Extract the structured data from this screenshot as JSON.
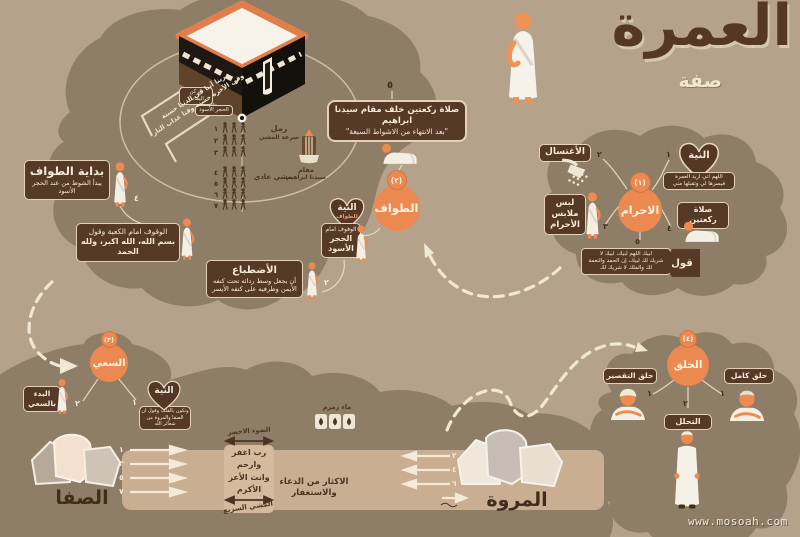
{
  "colors": {
    "background": "#b4a28b",
    "blob": "#8e7d67",
    "badge_brown": "#563a28",
    "accent_orange": "#eb8950",
    "cream": "#f3e9d6",
    "track_band": "#c9ae92",
    "title_brown": "#543823"
  },
  "title": {
    "main": "العمرة",
    "sub": "صفة"
  },
  "watermark": "www.mosoah.com",
  "kaaba": {
    "yemeni_corner": "الركن اليماني",
    "black_stone": "الحجر الأسود",
    "dua_l1": "ربنا آتنا في الدنيا حسنة",
    "dua_l2": "وفي الآخرة حسنة وقنا عذاب النار"
  },
  "ihram": {
    "circle_num": "(١)",
    "circle_label": "الاحرام",
    "niyyah": {
      "num": "١",
      "title": "النية",
      "l1": "اللهم اني اريد العمرة",
      "l2": "فيسرها لي وتقبلها مني"
    },
    "ghusl": {
      "num": "٢",
      "label": "الأغتسال"
    },
    "clothes": {
      "num": "٣",
      "l1": "لبس",
      "l2": "ملابس",
      "l3": "الأحرام"
    },
    "prayer": {
      "num": "٤",
      "label": "صلاة ركعتين"
    },
    "talbiyah": {
      "num": "٥",
      "tag": "قول",
      "l1": "لبيك اللهم لبيك، لبيك لا",
      "l2": "شريك لك لبيك، إن الحمد والنعمة",
      "l3": "لك والملك لا شريك لك"
    }
  },
  "tawaf": {
    "circle_num": "(٢)",
    "circle_label": "الطواف",
    "start": {
      "num": "٤",
      "title": "بداية الطواف",
      "sub": "يبدأ الشوط من عند الحجر الأسود"
    },
    "stand_kaaba": {
      "l1": "الوقوف امام الكعبة وقول",
      "l2": "بسم الله، الله اكبر، ولله الحمد"
    },
    "idtibaa": {
      "num": "٢",
      "title": "الأضطباع",
      "l1": "أن يجعل وسط ردائه تحت كتفه",
      "l2": "الأيمن وطرفيه على كتفه الأيسر"
    },
    "niyyah": {
      "title": "النية",
      "sub": "للطواف"
    },
    "stand_stone": {
      "l1": "الوقوف امام",
      "l2": "الحجر",
      "l3": "الأسود"
    },
    "raml": {
      "nums": [
        "١",
        "٢",
        "٣"
      ],
      "l1": "رمل",
      "l2": "سرعة المشي"
    },
    "walk": {
      "nums": [
        "٤",
        "٥",
        "٦",
        "٧"
      ],
      "label": "مشي عادي"
    },
    "maqam": {
      "l1": "مقام",
      "l2": "سيدنا ابراهيم"
    },
    "prayer": {
      "num": "٥",
      "l1": "صلاة ركعتين خلف مقام سيدنا ابراهيم",
      "l2": "\"بعد الانتهاء من الاشواط السبعة\""
    }
  },
  "sai": {
    "circle_num": "(٣)",
    "circle_label": "السعي",
    "niyyah": {
      "num": "١",
      "title": "النية",
      "l1": "وتكون بالقلب وقول ان",
      "l2": "الصفا والمروة من شعائر الله"
    },
    "start": {
      "num": "٢",
      "l1": "البدء",
      "l2": "بالسعي"
    },
    "safa": "الصفا",
    "marwa": "المروة",
    "to_marwa_nums": [
      "١",
      "٣",
      "٥",
      "٧"
    ],
    "to_safa_nums": [
      "٢",
      "٤",
      "٦"
    ],
    "green_light": "الضوء الاخضر",
    "dua": [
      "رب اغفر",
      "وارحم",
      "وانت الأعز",
      "الأكرم"
    ],
    "fast_walk": "المشي السريع",
    "dhikr": "الاكثار من الدعاء والاستغفار",
    "zamzam": "ماء زمزم"
  },
  "halq": {
    "circle_num": "(٤)",
    "circle_label": "الحلق",
    "trim": {
      "num": "١",
      "label": "حلق التقصير"
    },
    "full": {
      "num": "١",
      "label": "حلق كامل"
    },
    "tahallul": {
      "num": "٢",
      "label": "التحلل"
    }
  }
}
